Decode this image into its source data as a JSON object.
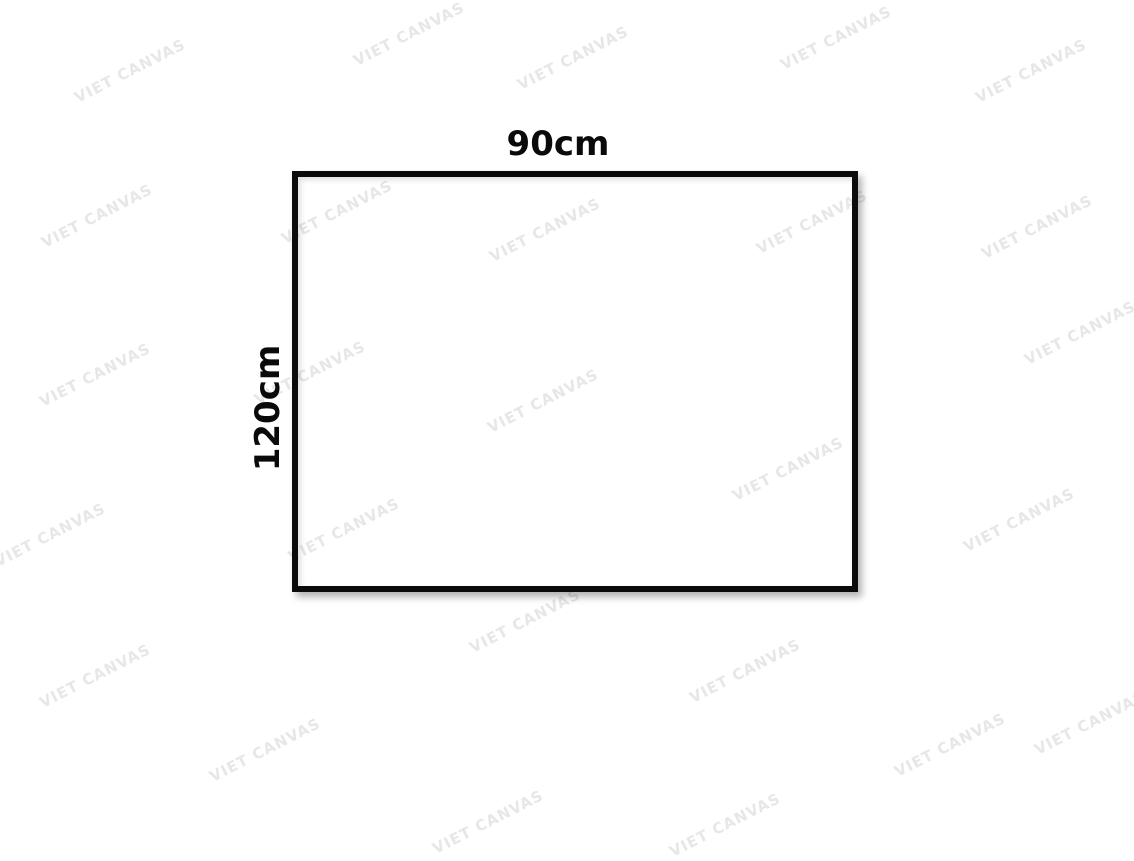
{
  "mockup": {
    "width_label": "90cm",
    "height_label": "120cm"
  },
  "watermark": {
    "text": "VIET CANVAS",
    "color": "#e7e7e7"
  },
  "colors": {
    "frame": "#0b0b0b",
    "background": "#ffffff",
    "label_text": "#0a0a0a"
  }
}
